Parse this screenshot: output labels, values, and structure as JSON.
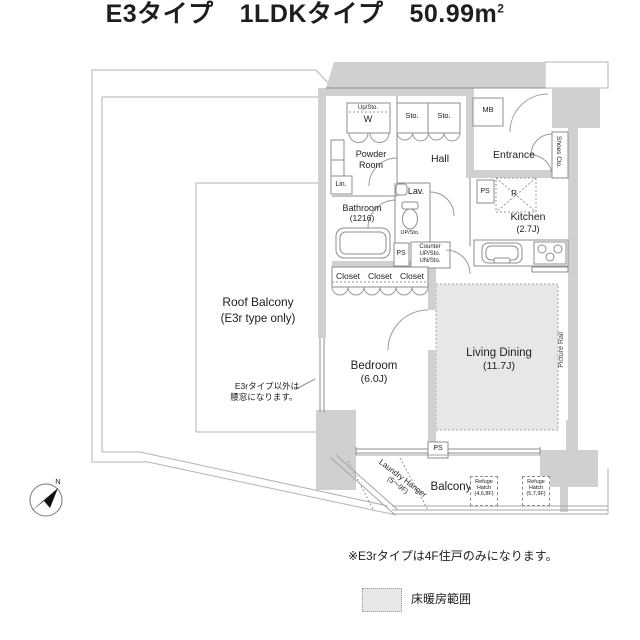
{
  "header": {
    "type_label": "E3タイプ",
    "plan_label": "1LDKタイプ",
    "area_value": "50.99m",
    "area_exp": "2"
  },
  "rooms": {
    "roof_balcony": {
      "name": "Roof Balcony",
      "note": "(E3r type only)"
    },
    "bedroom": {
      "name": "Bedroom",
      "size": "(6.0J)"
    },
    "living_dining": {
      "name": "Living Dining",
      "size": "(11.7J)"
    },
    "kitchen": {
      "name": "Kitchen",
      "size": "(2.7J)"
    },
    "bathroom": {
      "name": "Bathroom",
      "size": "(1216)"
    },
    "powder_room": {
      "line1": "Powder",
      "line2": "Room"
    },
    "hall": {
      "name": "Hall"
    },
    "entrance": {
      "name": "Entrance"
    },
    "lav": {
      "name": "Lav."
    },
    "balcony": {
      "name": "Balcony"
    }
  },
  "features": {
    "up_sto": "Up/Sto.",
    "washer": "W",
    "sto_left": "Sto.",
    "sto_right": "Sto.",
    "mb": "MB",
    "lin": "Lin.",
    "shoes_closet": "Shoes Clo.",
    "ps_kitchen": "PS",
    "refrigerator": "R",
    "ps_sanitary": "PS",
    "counter_line1": "Counter",
    "counter_line2": "UP/Sto.",
    "counter_line3": "UN/Sto.",
    "toilet_sto": "UP/Sto.",
    "closet_1": "Closet",
    "closet_2": "Closet",
    "closet_3": "Closet",
    "picture_rail": "Picture Rail",
    "ps_living": "PS",
    "laundry_line1": "Laundry Hanger",
    "laundry_line2": "(5〜9F)",
    "refuge_left": {
      "line1": "Refuge",
      "line2": "Hatch",
      "line3": "(4,6,8F)"
    },
    "refuge_right": {
      "line1": "Refuge",
      "line2": "Hatch",
      "line3": "(5,7,9F)"
    },
    "compass_n": "N"
  },
  "annotations": {
    "window_note_line1": "E3rタイプ以外は",
    "window_note_line2": "腰窓になります。",
    "type_note": "※E3rタイプは4F住戸のみになります。",
    "legend_label": "床暖房範囲"
  },
  "colors": {
    "wall": "#d0d0d0",
    "floor_heating": "#e7e7e7",
    "line": "#8c8c8c",
    "text": "#1c1c1c"
  }
}
